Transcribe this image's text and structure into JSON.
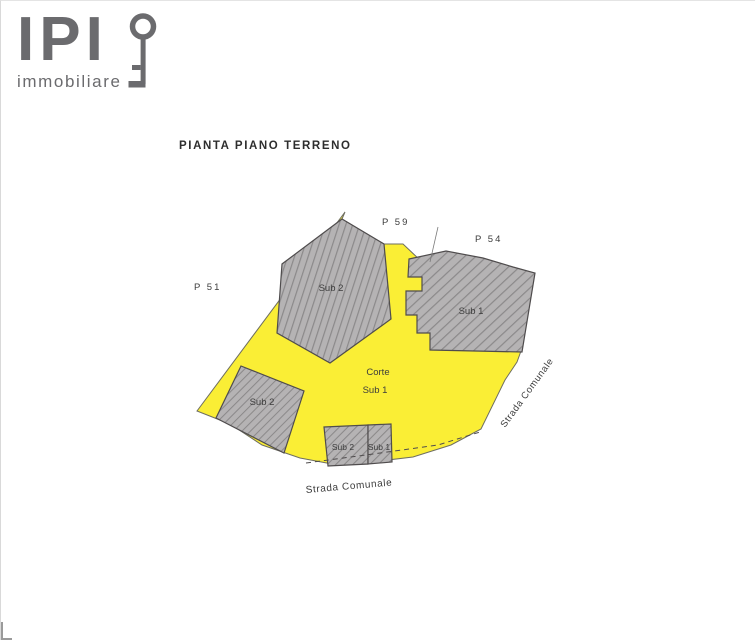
{
  "logo": {
    "name": "IPI",
    "tagline": "immobiliare"
  },
  "title": "PIANTA PIANO TERRENO",
  "plan": {
    "parcels": {
      "p51": "P 51",
      "p59": "P 59",
      "p54": "P 54"
    },
    "buildings": {
      "upper_left_label": "Sub 2",
      "main_right_label": "Sub 1",
      "mid_left_label": "Sub 2",
      "bottom_left_label": "Sub 2",
      "bottom_right_label": "Sub 1"
    },
    "courtyard": {
      "line1": "Corte",
      "line2": "Sub 1"
    },
    "roads": {
      "bottom": "Strada Comunale",
      "right": "Strada Comunale"
    },
    "colors": {
      "courtyard": "#FAEE35",
      "bfill": "#B5B3B4",
      "hatch": "#8B898A",
      "outline": "#4F4C4D",
      "label": "#3C3C3C",
      "logo": "#6B6B6E",
      "title": "#2E2E2E"
    }
  }
}
